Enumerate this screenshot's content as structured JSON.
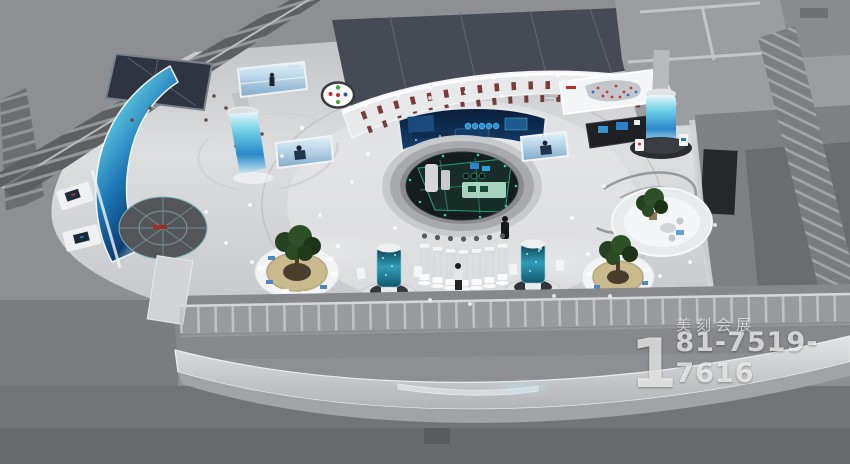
{
  "watermark": {
    "brand": "美刻会展",
    "phone_big_digit": "1",
    "phone_rest": "81-7519-7616",
    "phone_full": "181-7519-7616"
  },
  "scene": {
    "type": "3d-render-aerial-exhibition-hall",
    "colors": {
      "background_gray": "#8e8f92",
      "hall_floor": "#d8dadc",
      "screen_navy": "#0c2142",
      "led_cyan": "#6fd0e8",
      "led_blue": "#1e78b8",
      "product_box_red": "#7c3a3a",
      "sandtable_green": "#2f9e74",
      "plant_green": "#2e5026",
      "planter_tan": "#c9ba8e",
      "glass_teal": "#2f9cb8"
    }
  }
}
